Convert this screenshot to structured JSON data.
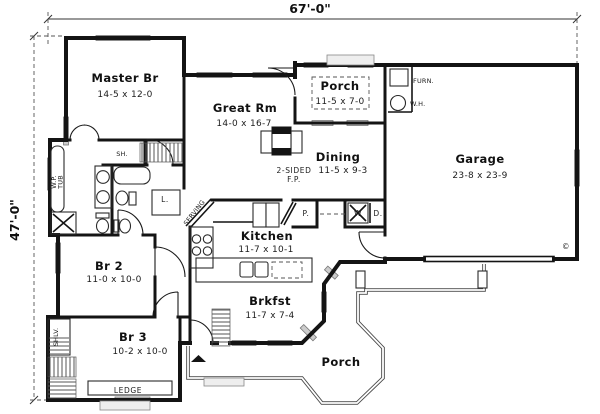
{
  "plan": {
    "dim_width": "67'-0\"",
    "dim_height": "47'-0\"",
    "copyright_symbol": "©",
    "rooms": {
      "master": {
        "name": "Master Br",
        "dims": "14-5 x 12-0"
      },
      "great_rm": {
        "name": "Great Rm",
        "dims": "14-0 x 16-7"
      },
      "porch_top": {
        "name": "Porch",
        "dims": "11-5 x 7-0"
      },
      "dining": {
        "name": "Dining",
        "dims": "11-5 x 9-3"
      },
      "garage": {
        "name": "Garage",
        "dims": "23-8 x 23-9"
      },
      "kitchen": {
        "name": "Kitchen",
        "dims": "11-7 x 10-1"
      },
      "brkfst": {
        "name": "Brkfst",
        "dims": "11-7 x 7-4"
      },
      "br2": {
        "name": "Br 2",
        "dims": "11-0 x 10-0"
      },
      "br3": {
        "name": "Br 3",
        "dims": "10-2 x 10-0"
      },
      "porch_bottom": {
        "name": "Porch"
      }
    },
    "fixtures": {
      "furnace": "FURN.",
      "water_heater": "W.H.",
      "fireplace_line1": "2-SIDED",
      "fireplace_line2": "F.P.",
      "pantry": "P.",
      "washer": "W",
      "dryer": "D.",
      "linen": "L.",
      "closet_shelf": "SH.",
      "shelves": "SHLV.",
      "whirlpool_line1": "W.P.",
      "whirlpool_line2": "TUB",
      "ledge": "LEDGE",
      "serving": "SERVING"
    }
  }
}
